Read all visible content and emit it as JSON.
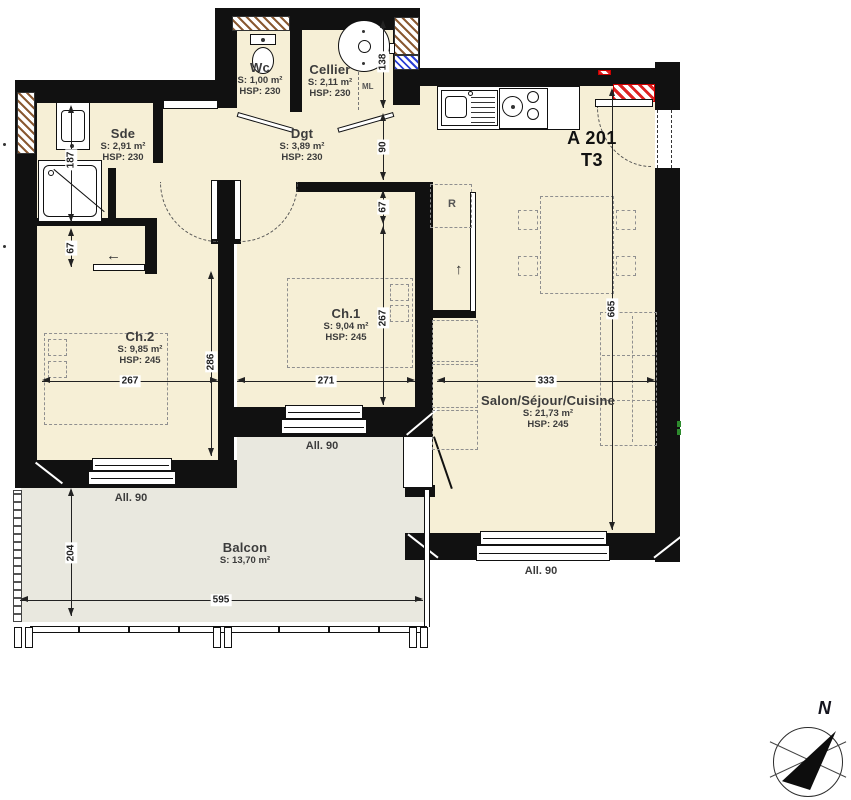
{
  "plan": {
    "unit": {
      "code": "A 201",
      "type": "T3"
    },
    "rooms": [
      {
        "id": "wc",
        "name": "Wc",
        "area": "S: 1,00 m²",
        "hsp": "HSP: 230"
      },
      {
        "id": "cellier",
        "name": "Cellier",
        "area": "S: 2,11 m²",
        "hsp": "HSP: 230"
      },
      {
        "id": "sde",
        "name": "Sde",
        "area": "S: 2,91 m²",
        "hsp": "HSP: 230"
      },
      {
        "id": "dgt",
        "name": "Dgt",
        "area": "S: 3,89 m²",
        "hsp": "HSP: 230"
      },
      {
        "id": "ch2",
        "name": "Ch.2",
        "area": "S: 9,85 m²",
        "hsp": "HSP: 245"
      },
      {
        "id": "ch1",
        "name": "Ch.1",
        "area": "S: 9,04 m²",
        "hsp": "HSP: 245"
      },
      {
        "id": "salon",
        "name": "Salon/Séjour/Cuisine",
        "area": "S: 21,73 m²",
        "hsp": "HSP: 245"
      },
      {
        "id": "balcon",
        "name": "Balcon",
        "area": "S: 13,70 m²"
      }
    ],
    "dimensions": {
      "v187": "187",
      "v67_sde": "67",
      "v204": "204",
      "v286": "286",
      "v138": "138",
      "v90": "90",
      "v67_ch1": "67",
      "v267_ch1": "267",
      "v665": "665",
      "h267": "267",
      "h271": "271",
      "h333": "333",
      "h595": "595"
    },
    "annotations": {
      "allege": "All. 90",
      "ml": "ML",
      "fridge": "R"
    },
    "compass": {
      "north": "N"
    },
    "colors": {
      "floor": "#f6efd6",
      "balcony": "#e9e8df",
      "wall": "#111111",
      "hatch_brown": "#8a5a33",
      "hatch_blue": "#2b3fd4",
      "hatch_red": "#dd2222",
      "dimension_text": "#222222"
    }
  }
}
